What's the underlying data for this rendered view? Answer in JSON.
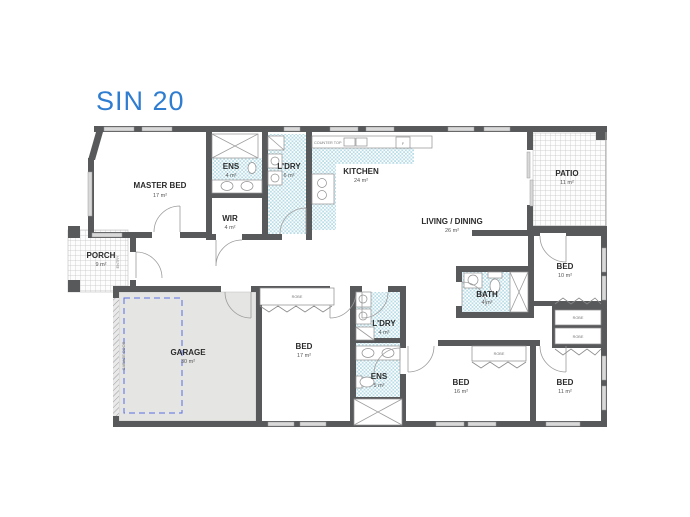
{
  "title": "SIN 20",
  "rooms": {
    "master_bed": {
      "name": "MASTER BED",
      "area": "17 m²"
    },
    "ens_top": {
      "name": "ENS",
      "area": "4 m²"
    },
    "ldry_top": {
      "name": "L'DRY",
      "area": "6 m²"
    },
    "wir": {
      "name": "WIR",
      "area": "4 m²"
    },
    "kitchen": {
      "name": "KITCHEN",
      "area": "24 m²"
    },
    "living": {
      "name": "LIVING / DINING",
      "area": "26 m²"
    },
    "patio": {
      "name": "PATIO",
      "area": "11 m²"
    },
    "porch": {
      "name": "PORCH",
      "area": "9 m²"
    },
    "bed10": {
      "name": "BED",
      "area": "10 m²"
    },
    "bath": {
      "name": "BATH",
      "area": "4 m²"
    },
    "garage": {
      "name": "GARAGE",
      "area": "30 m²"
    },
    "bed17": {
      "name": "BED",
      "area": "17 m²"
    },
    "ldry_bottom": {
      "name": "L'DRY",
      "area": "4 m²"
    },
    "ens_bottom": {
      "name": "ENS",
      "area": "5 m²"
    },
    "bed16": {
      "name": "BED",
      "area": "16 m²"
    },
    "bed11": {
      "name": "BED",
      "area": "11 m²"
    }
  },
  "annotations": {
    "counter_top": "COUNTER TOP",
    "entry": "ENTRY",
    "garage_door": "GARAGE DOOR",
    "robe": "ROBE",
    "fridge": "F"
  },
  "colors": {
    "title_blue": "#2f7dd0",
    "wall_gray": "#58595b",
    "tile_blue": "#b9dde7",
    "garage_fill": "#e5e5e3",
    "car_dash_blue": "#5b6ee1"
  }
}
